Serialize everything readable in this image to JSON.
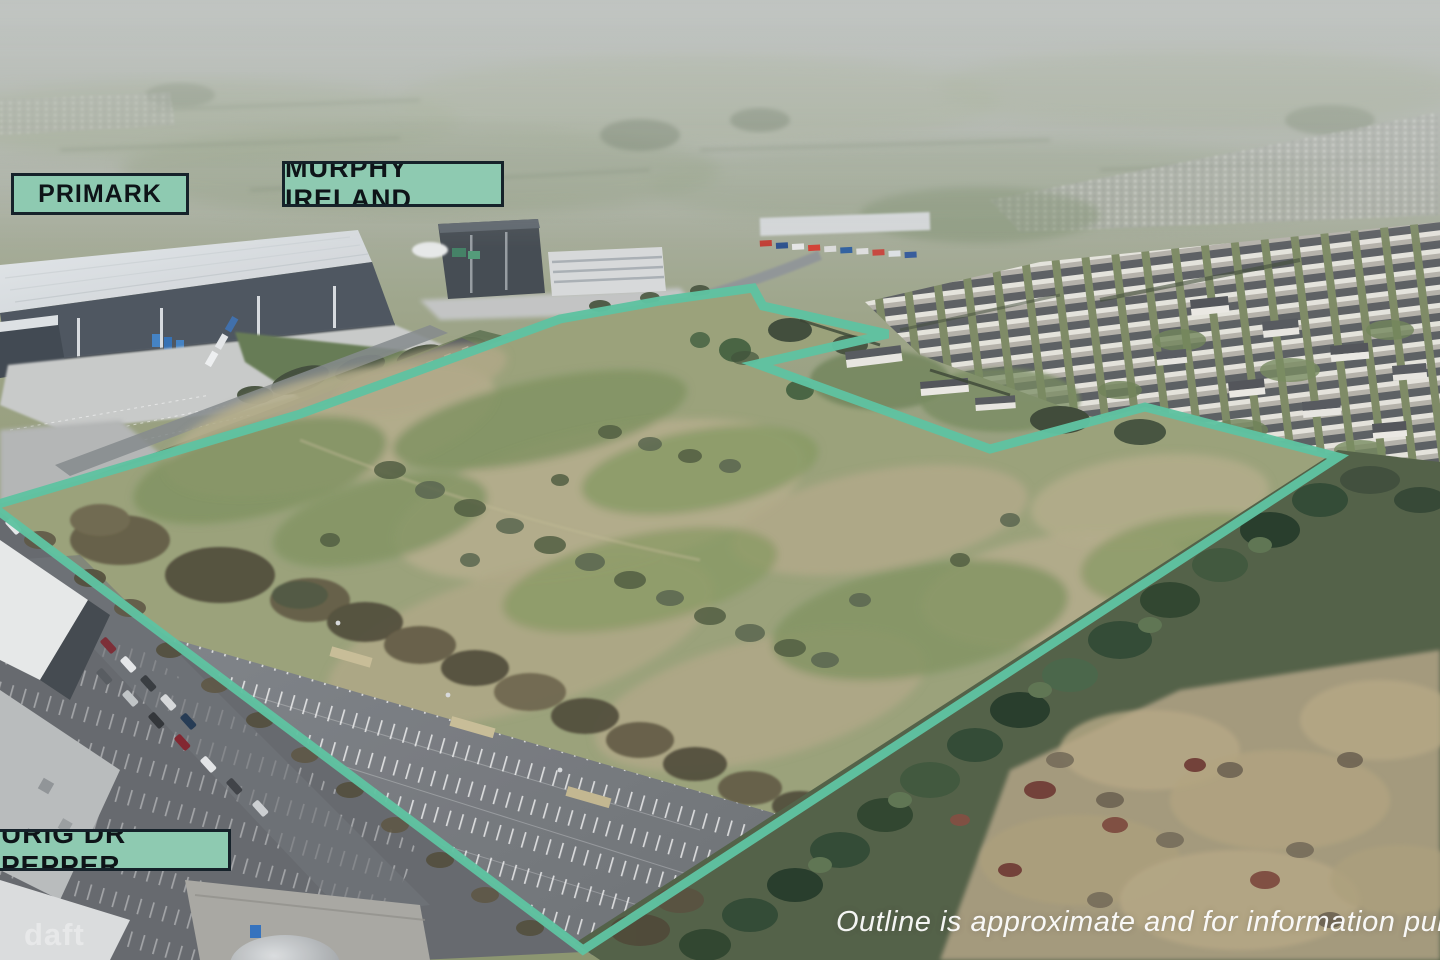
{
  "annotations": {
    "labels": [
      {
        "id": "primark",
        "text": "PRIMARK"
      },
      {
        "id": "murphy_ireland",
        "text": "MURPHY IRELAND"
      },
      {
        "id": "keurig_dr_pepper",
        "text": "URIG DR PEPPER"
      }
    ],
    "disclaimer": "Outline is approximate and for information purpos",
    "watermark": "daft"
  },
  "colors": {
    "outline": "#5fc2a1",
    "label_background": "#8ecab1",
    "label_border": "#16222a",
    "label_text": "#0e1418"
  },
  "outline": {
    "stroke_width": 9,
    "points": [
      [
        -8,
        506
      ],
      [
        300,
        414
      ],
      [
        560,
        319
      ],
      [
        660,
        301
      ],
      [
        753,
        288
      ],
      [
        763,
        306
      ],
      [
        888,
        334
      ],
      [
        757,
        364
      ],
      [
        990,
        449
      ],
      [
        1145,
        407
      ],
      [
        1338,
        457
      ],
      [
        583,
        950
      ]
    ]
  }
}
